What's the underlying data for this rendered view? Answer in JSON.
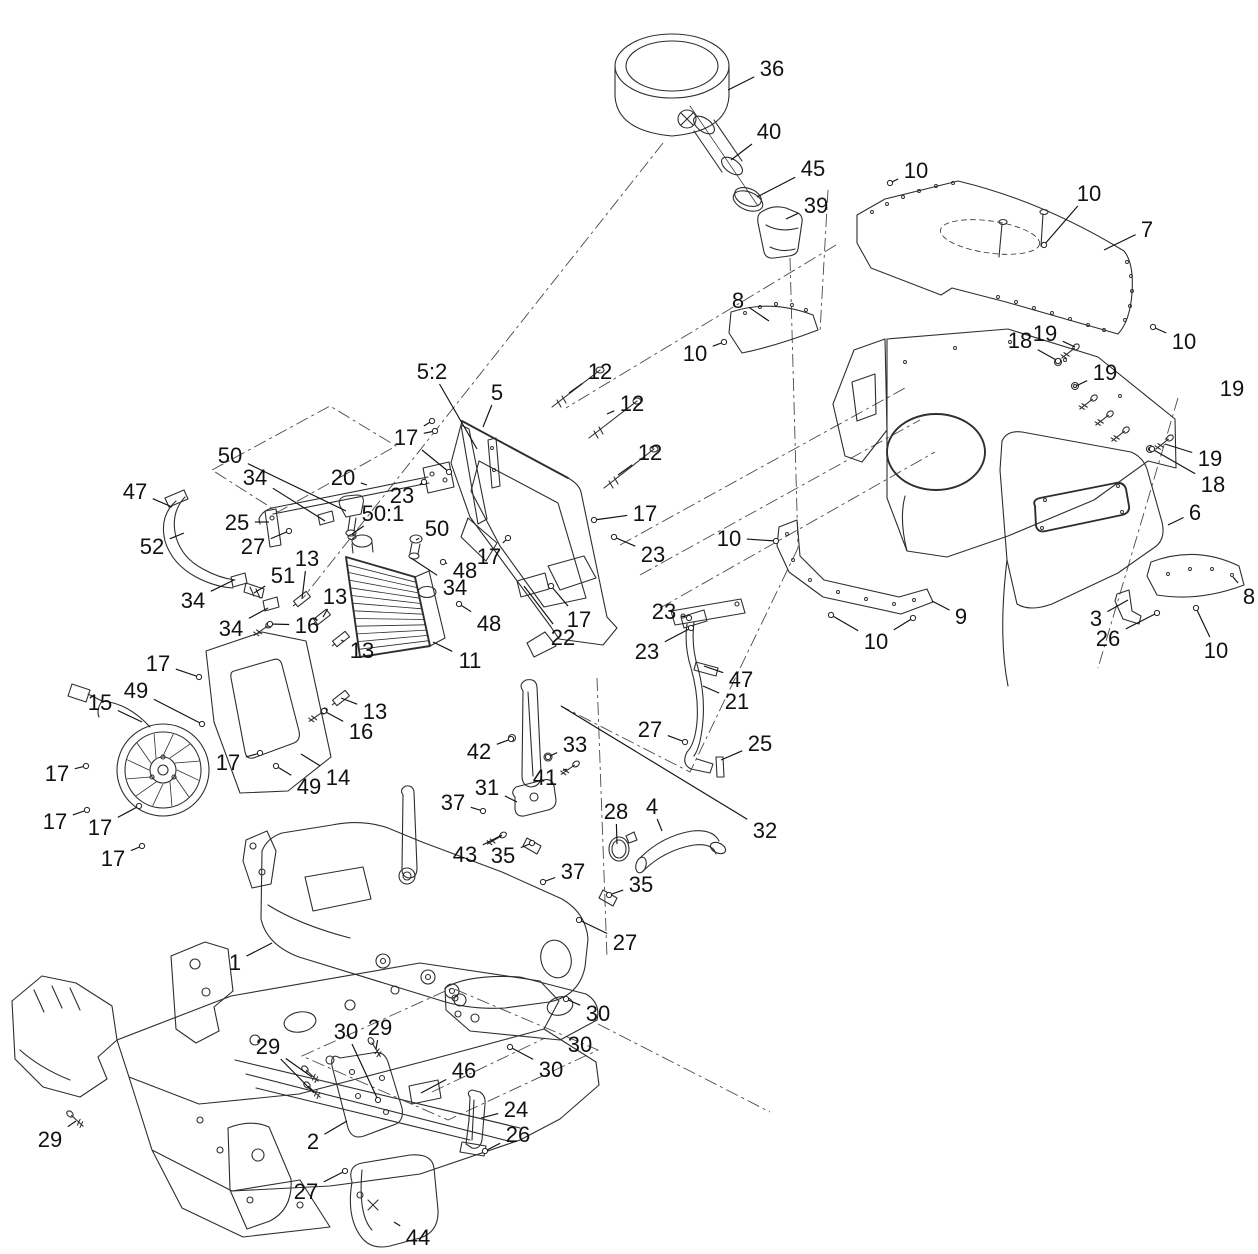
{
  "figure": {
    "kind": "exploded-parts-diagram",
    "background": "#ffffff",
    "line_color": "#2e2e2e",
    "label_color": "#111111",
    "label_font_px": 22
  },
  "callouts": [
    {
      "n": "36",
      "x": 772,
      "y": 68,
      "e": [
        [
          728,
          90
        ]
      ]
    },
    {
      "n": "40",
      "x": 769,
      "y": 131,
      "e": [
        [
          731,
          160
        ]
      ]
    },
    {
      "n": "45",
      "x": 813,
      "y": 168,
      "e": [
        [
          757,
          197
        ]
      ]
    },
    {
      "n": "39",
      "x": 816,
      "y": 205,
      "e": [
        [
          786,
          219
        ]
      ]
    },
    {
      "n": "10",
      "x": 916,
      "y": 170,
      "e": [
        [
          890,
          183
        ]
      ]
    },
    {
      "n": "10",
      "x": 1089,
      "y": 193,
      "e": [
        [
          1044,
          245
        ]
      ]
    },
    {
      "n": "7",
      "x": 1147,
      "y": 229,
      "e": [
        [
          1104,
          250
        ]
      ]
    },
    {
      "n": "8",
      "x": 738,
      "y": 300,
      "e": [
        [
          769,
          321
        ]
      ]
    },
    {
      "n": "10",
      "x": 695,
      "y": 353,
      "e": [
        [
          724,
          342
        ]
      ]
    },
    {
      "n": "18",
      "x": 1020,
      "y": 340,
      "e": [
        [
          1058,
          361
        ]
      ]
    },
    {
      "n": "19",
      "x": 1045,
      "y": 333,
      "e": [
        [
          1075,
          347
        ]
      ]
    },
    {
      "n": "19",
      "x": 1105,
      "y": 372,
      "e": [
        [
          1076,
          386
        ]
      ]
    },
    {
      "n": "10",
      "x": 1184,
      "y": 341,
      "e": [
        [
          1153,
          327
        ]
      ]
    },
    {
      "n": "19",
      "x": 1232,
      "y": 388,
      "e": []
    },
    {
      "n": "19",
      "x": 1210,
      "y": 458,
      "e": [
        [
          1165,
          444
        ]
      ]
    },
    {
      "n": "18",
      "x": 1213,
      "y": 484,
      "e": [
        [
          1152,
          449
        ]
      ]
    },
    {
      "n": "6",
      "x": 1195,
      "y": 512,
      "e": [
        [
          1168,
          525
        ]
      ]
    },
    {
      "n": "8",
      "x": 1249,
      "y": 596,
      "e": [
        [
          1233,
          577
        ]
      ]
    },
    {
      "n": "9",
      "x": 961,
      "y": 616,
      "e": [
        [
          932,
          601
        ]
      ]
    },
    {
      "n": "10",
      "x": 876,
      "y": 641,
      "e": [
        [
          831,
          615
        ],
        [
          913,
          618
        ]
      ]
    },
    {
      "n": "3",
      "x": 1096,
      "y": 618,
      "e": [
        [
          1128,
          600
        ]
      ]
    },
    {
      "n": "26",
      "x": 1108,
      "y": 638,
      "e": [
        [
          1157,
          613
        ]
      ]
    },
    {
      "n": "10",
      "x": 1216,
      "y": 650,
      "e": [
        [
          1196,
          608
        ]
      ]
    },
    {
      "n": "10",
      "x": 729,
      "y": 538,
      "e": [
        [
          776,
          541
        ]
      ]
    },
    {
      "n": "5:2",
      "x": 432,
      "y": 371,
      "e": [
        [
          477,
          449
        ]
      ]
    },
    {
      "n": "5",
      "x": 497,
      "y": 392,
      "e": [
        [
          483,
          427
        ]
      ]
    },
    {
      "n": "12",
      "x": 600,
      "y": 371,
      "e": [
        [
          569,
          393
        ]
      ]
    },
    {
      "n": "12",
      "x": 632,
      "y": 403,
      "e": [
        [
          607,
          414
        ]
      ]
    },
    {
      "n": "12",
      "x": 650,
      "y": 452,
      "e": [
        [
          618,
          475
        ]
      ]
    },
    {
      "n": "17",
      "x": 406,
      "y": 437,
      "e": [
        [
          432,
          421
        ],
        [
          435,
          431
        ],
        [
          449,
          472
        ]
      ]
    },
    {
      "n": "50",
      "x": 230,
      "y": 455,
      "e": [
        [
          346,
          511
        ]
      ]
    },
    {
      "n": "34",
      "x": 255,
      "y": 477,
      "e": [
        [
          325,
          521
        ]
      ]
    },
    {
      "n": "20",
      "x": 343,
      "y": 477,
      "e": [
        [
          367,
          485
        ]
      ]
    },
    {
      "n": "23",
      "x": 402,
      "y": 495,
      "e": [
        [
          424,
          482
        ]
      ]
    },
    {
      "n": "50:1",
      "x": 383,
      "y": 513,
      "e": [
        [
          352,
          534
        ]
      ]
    },
    {
      "n": "47",
      "x": 135,
      "y": 491,
      "e": [
        [
          172,
          507
        ]
      ]
    },
    {
      "n": "25",
      "x": 237,
      "y": 522,
      "e": [
        [
          269,
          522
        ]
      ]
    },
    {
      "n": "27",
      "x": 253,
      "y": 546,
      "e": [
        [
          289,
          531
        ]
      ]
    },
    {
      "n": "52",
      "x": 152,
      "y": 546,
      "e": [
        [
          184,
          533
        ]
      ]
    },
    {
      "n": "50",
      "x": 437,
      "y": 528,
      "e": [
        [
          416,
          540
        ]
      ]
    },
    {
      "n": "17",
      "x": 645,
      "y": 513,
      "e": [
        [
          594,
          520
        ]
      ]
    },
    {
      "n": "23",
      "x": 653,
      "y": 554,
      "e": [
        [
          614,
          537
        ]
      ]
    },
    {
      "n": "13",
      "x": 307,
      "y": 558,
      "e": [
        [
          302,
          599
        ]
      ]
    },
    {
      "n": "51",
      "x": 283,
      "y": 575,
      "e": [
        [
          254,
          593
        ]
      ]
    },
    {
      "n": "34",
      "x": 193,
      "y": 600,
      "e": [
        [
          234,
          580
        ]
      ]
    },
    {
      "n": "34",
      "x": 231,
      "y": 628,
      "e": [
        [
          268,
          608
        ]
      ]
    },
    {
      "n": "16",
      "x": 307,
      "y": 625,
      "e": [
        [
          270,
          624
        ]
      ]
    },
    {
      "n": "13",
      "x": 335,
      "y": 596,
      "e": [
        [
          323,
          617
        ]
      ]
    },
    {
      "n": "48",
      "x": 465,
      "y": 570,
      "e": [
        [
          443,
          562
        ]
      ]
    },
    {
      "n": "17",
      "x": 489,
      "y": 556,
      "e": [
        [
          508,
          538
        ]
      ]
    },
    {
      "n": "34",
      "x": 455,
      "y": 587,
      "e": [
        [
          411,
          558
        ]
      ]
    },
    {
      "n": "48",
      "x": 489,
      "y": 623,
      "e": [
        [
          459,
          604
        ]
      ]
    },
    {
      "n": "22",
      "x": 563,
      "y": 637,
      "e": [
        [
          524,
          586
        ]
      ]
    },
    {
      "n": "17",
      "x": 579,
      "y": 619,
      "e": [
        [
          551,
          586
        ]
      ]
    },
    {
      "n": "13",
      "x": 362,
      "y": 650,
      "e": [
        [
          341,
          640
        ]
      ]
    },
    {
      "n": "17",
      "x": 158,
      "y": 663,
      "e": [
        [
          199,
          677
        ]
      ]
    },
    {
      "n": "11",
      "x": 470,
      "y": 660,
      "e": [
        [
          433,
          642
        ]
      ]
    },
    {
      "n": "23",
      "x": 664,
      "y": 611,
      "e": [
        [
          689,
          618
        ]
      ]
    },
    {
      "n": "23",
      "x": 647,
      "y": 651,
      "e": [
        [
          691,
          628
        ]
      ]
    },
    {
      "n": "47",
      "x": 741,
      "y": 679,
      "e": [
        [
          704,
          666
        ]
      ]
    },
    {
      "n": "21",
      "x": 737,
      "y": 701,
      "e": [
        [
          703,
          686
        ]
      ]
    },
    {
      "n": "27",
      "x": 650,
      "y": 729,
      "e": [
        [
          685,
          742
        ]
      ]
    },
    {
      "n": "25",
      "x": 760,
      "y": 743,
      "e": [
        [
          721,
          760
        ]
      ]
    },
    {
      "n": "15",
      "x": 100,
      "y": 702,
      "e": [
        [
          142,
          722
        ]
      ]
    },
    {
      "n": "49",
      "x": 136,
      "y": 690,
      "e": [
        [
          202,
          724
        ]
      ]
    },
    {
      "n": "13",
      "x": 375,
      "y": 711,
      "e": [
        [
          341,
          698
        ]
      ]
    },
    {
      "n": "16",
      "x": 361,
      "y": 731,
      "e": [
        [
          324,
          711
        ]
      ]
    },
    {
      "n": "42",
      "x": 479,
      "y": 751,
      "e": [
        [
          511,
          739
        ]
      ]
    },
    {
      "n": "33",
      "x": 575,
      "y": 744,
      "e": [
        [
          548,
          757
        ]
      ]
    },
    {
      "n": "41",
      "x": 545,
      "y": 777,
      "e": [
        [
          567,
          769
        ]
      ]
    },
    {
      "n": "17",
      "x": 57,
      "y": 773,
      "e": [
        [
          86,
          766
        ]
      ]
    },
    {
      "n": "17",
      "x": 228,
      "y": 762,
      "e": [
        [
          260,
          753
        ]
      ]
    },
    {
      "n": "49",
      "x": 309,
      "y": 786,
      "e": [
        [
          276,
          766
        ]
      ]
    },
    {
      "n": "14",
      "x": 338,
      "y": 777,
      "e": [
        [
          301,
          754
        ]
      ]
    },
    {
      "n": "31",
      "x": 487,
      "y": 787,
      "e": [
        [
          517,
          802
        ]
      ]
    },
    {
      "n": "37",
      "x": 453,
      "y": 802,
      "e": [
        [
          483,
          811
        ]
      ]
    },
    {
      "n": "17",
      "x": 55,
      "y": 821,
      "e": [
        [
          87,
          810
        ]
      ]
    },
    {
      "n": "17",
      "x": 100,
      "y": 827,
      "e": [
        [
          139,
          806
        ]
      ]
    },
    {
      "n": "28",
      "x": 616,
      "y": 811,
      "e": [
        [
          617,
          844
        ]
      ]
    },
    {
      "n": "4",
      "x": 652,
      "y": 806,
      "e": [
        [
          662,
          831
        ]
      ]
    },
    {
      "n": "32",
      "x": 765,
      "y": 830,
      "e": [
        [
          561,
          706
        ]
      ]
    },
    {
      "n": "43",
      "x": 465,
      "y": 854,
      "e": [
        [
          502,
          835
        ]
      ]
    },
    {
      "n": "35",
      "x": 503,
      "y": 855,
      "e": [
        [
          532,
          843
        ]
      ]
    },
    {
      "n": "17",
      "x": 113,
      "y": 858,
      "e": [
        [
          142,
          846
        ]
      ]
    },
    {
      "n": "37",
      "x": 573,
      "y": 871,
      "e": [
        [
          543,
          882
        ]
      ]
    },
    {
      "n": "35",
      "x": 641,
      "y": 884,
      "e": [
        [
          609,
          895
        ]
      ]
    },
    {
      "n": "27",
      "x": 625,
      "y": 942,
      "e": [
        [
          579,
          920
        ]
      ]
    },
    {
      "n": "1",
      "x": 235,
      "y": 962,
      "e": [
        [
          272,
          943
        ]
      ]
    },
    {
      "n": "30",
      "x": 598,
      "y": 1013,
      "e": [
        [
          566,
          999
        ]
      ]
    },
    {
      "n": "29",
      "x": 380,
      "y": 1027,
      "e": [
        [
          376,
          1049
        ]
      ]
    },
    {
      "n": "30",
      "x": 346,
      "y": 1031,
      "e": [
        [
          378,
          1100
        ]
      ]
    },
    {
      "n": "30",
      "x": 580,
      "y": 1044,
      "e": []
    },
    {
      "n": "30",
      "x": 551,
      "y": 1069,
      "e": [
        [
          510,
          1047
        ]
      ]
    },
    {
      "n": "29",
      "x": 268,
      "y": 1046,
      "e": [
        [
          312,
          1077
        ],
        [
          314,
          1093
        ]
      ]
    },
    {
      "n": "46",
      "x": 464,
      "y": 1070,
      "e": [
        [
          421,
          1093
        ]
      ]
    },
    {
      "n": "24",
      "x": 516,
      "y": 1109,
      "e": [
        [
          481,
          1118
        ]
      ]
    },
    {
      "n": "26",
      "x": 518,
      "y": 1134,
      "e": [
        [
          485,
          1151
        ]
      ]
    },
    {
      "n": "2",
      "x": 313,
      "y": 1141,
      "e": [
        [
          347,
          1121
        ]
      ]
    },
    {
      "n": "29",
      "x": 50,
      "y": 1139,
      "e": [
        [
          76,
          1121
        ]
      ]
    },
    {
      "n": "27",
      "x": 306,
      "y": 1191,
      "e": [
        [
          345,
          1171
        ]
      ]
    },
    {
      "n": "44",
      "x": 418,
      "y": 1237,
      "e": [
        [
          394,
          1222
        ]
      ]
    }
  ]
}
